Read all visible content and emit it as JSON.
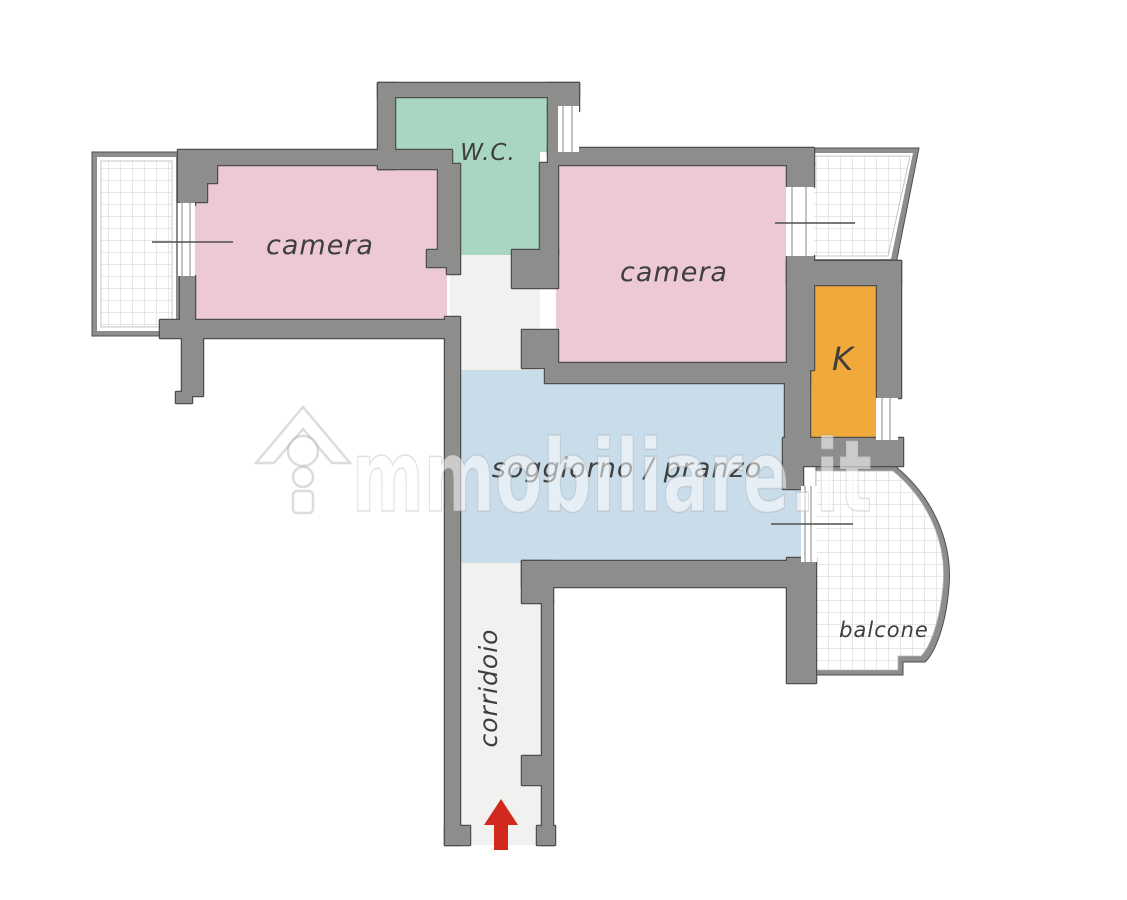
{
  "plan": {
    "title": "apartment-floor-plan",
    "rooms": {
      "camera_left": {
        "label": "camera"
      },
      "wc": {
        "label": "W.C."
      },
      "camera_right": {
        "label": "camera"
      },
      "kitchen": {
        "label": "K"
      },
      "living": {
        "label": "soggiorno / pranzo"
      },
      "corridor": {
        "label": "corridoio"
      },
      "balcony": {
        "label": "balcone"
      }
    },
    "colors": {
      "background": "#ffffff",
      "camera": "#ecc9d5",
      "wc": "#a8d6c0",
      "kitchen": "#f2a93c",
      "living": "#c9dcea",
      "corridor": "#f1f1ef",
      "hall": "#f1f1ef",
      "balcony_fill": "#ffffff",
      "balcony_grid": "#d0d0d0",
      "wall": "#8d8d8c",
      "wall_outline": "#4e4e4e",
      "window_frame": "#9a9a9a",
      "sill_line": "#4f4f4f",
      "label_text": "#3e3e3e",
      "entrance_arrow": "#d2291f"
    },
    "watermark": {
      "brand_full": "immobiliare.it",
      "text_after_icon": "mmobiliare.it"
    }
  }
}
